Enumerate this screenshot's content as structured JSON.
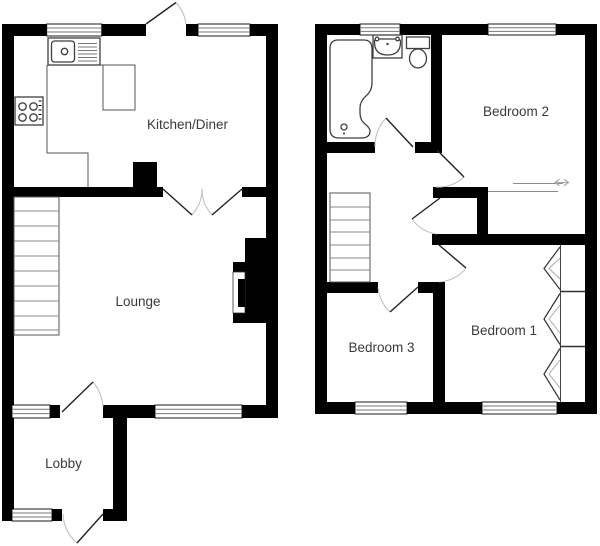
{
  "canvas": {
    "width": 600,
    "height": 546,
    "background": "#ffffff"
  },
  "colors": {
    "wall": "#000000",
    "room_fill": "#ffffff",
    "label_text": "#3a3a3a",
    "fixture_stroke": "#3f3f3f",
    "door_arc": "#bcbcbc",
    "stair_tread": "#8a8a8a",
    "window_line": "#777777"
  },
  "floors": {
    "ground": {
      "rooms": [
        {
          "label": "Kitchen/Diner"
        },
        {
          "label": "Lounge"
        },
        {
          "label": "Lobby"
        }
      ],
      "fixtures": [
        "kitchen-sink",
        "draining-board",
        "hob",
        "worktop",
        "stairs",
        "fireplace",
        "double-doors",
        "back-door",
        "entrance-door"
      ]
    },
    "first": {
      "rooms": [
        {
          "label": "Bedroom 2"
        },
        {
          "label": "Bedroom 3"
        },
        {
          "label": "Bedroom 1"
        }
      ],
      "fixtures": [
        "bath",
        "wash-basin",
        "toilet",
        "stairs",
        "landing-cupboard",
        "built-in-wardrobes",
        "sliding-door-arrow"
      ]
    }
  }
}
